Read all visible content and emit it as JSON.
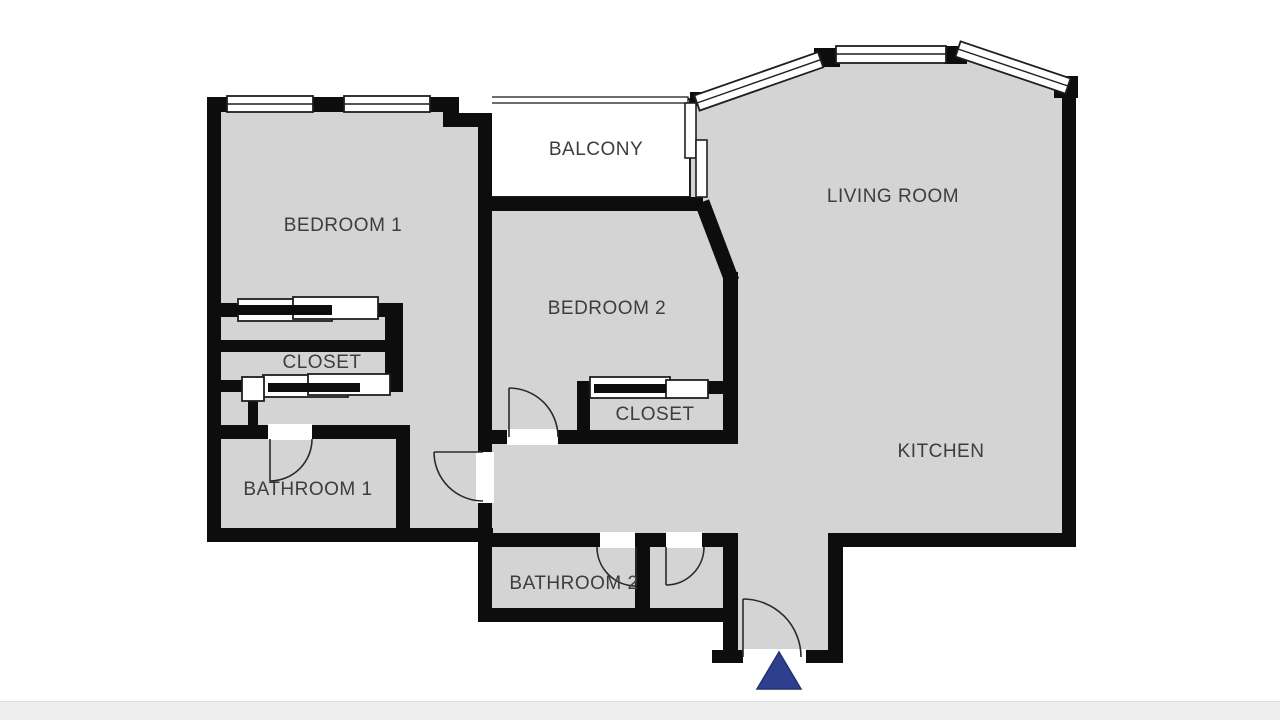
{
  "floorplan": {
    "wall_color": "#0d0d0d",
    "floor_color": "#d4d4d4",
    "balcony_floor_color": "#ffffff",
    "label_color": "#3d3d3d",
    "entrance_marker_color": "#2e3f8f",
    "footer_strip_color": "#ededed",
    "rooms": [
      {
        "id": "bedroom-1",
        "label": "BEDROOM 1"
      },
      {
        "id": "balcony",
        "label": "BALCONY"
      },
      {
        "id": "living-room",
        "label": "LIVING ROOM"
      },
      {
        "id": "bedroom-2",
        "label": "BEDROOM 2"
      },
      {
        "id": "closet-1",
        "label": "CLOSET"
      },
      {
        "id": "closet-2",
        "label": "CLOSET"
      },
      {
        "id": "kitchen",
        "label": "KITCHEN"
      },
      {
        "id": "bathroom-1",
        "label": "BATHROOM 1"
      },
      {
        "id": "bathroom-2",
        "label": "BATHROOM 2"
      }
    ]
  }
}
